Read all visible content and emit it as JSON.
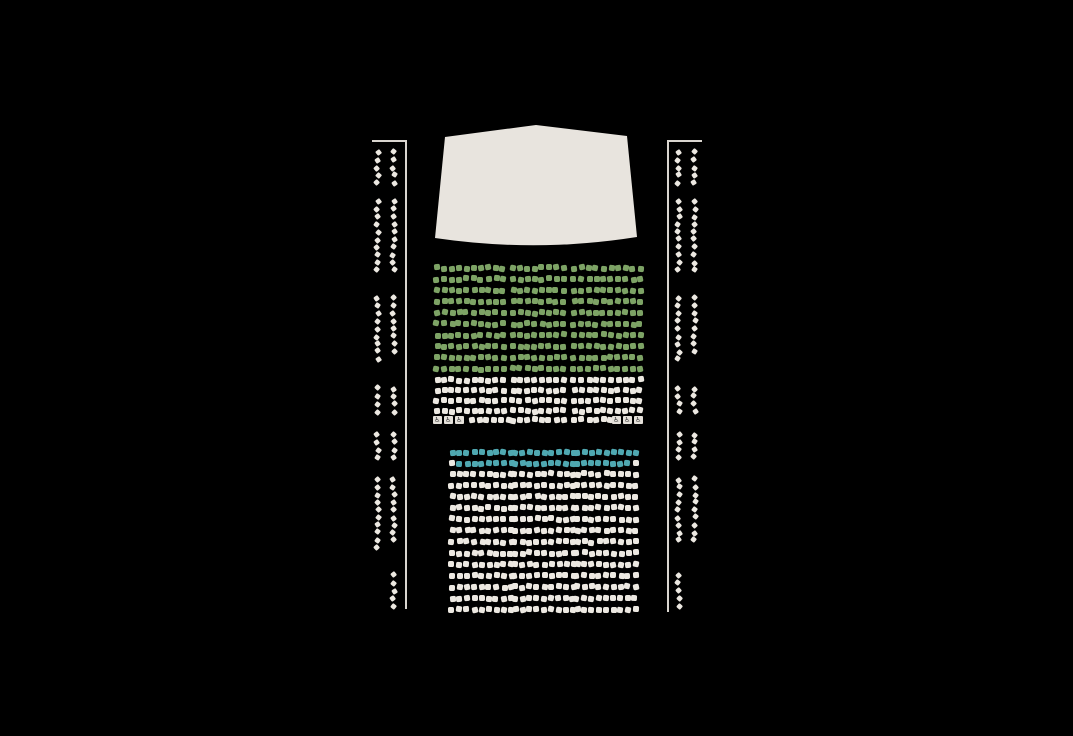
{
  "colors": {
    "background": "#000000",
    "stage_fill": "#e8e4de",
    "outline_line": "#d9d5cf",
    "green": "#7da365",
    "teal": "#4fa8b1",
    "cream": "#ece8e1",
    "wheelchair_fill": "#e5e1da",
    "wheelchair_glyph": "#3b3b3b"
  },
  "icons": {
    "wheelchair": "♿"
  },
  "seatmap": {
    "center_sections": [
      {
        "id": "front-orchestra",
        "blocks": [
          {
            "x": 434,
            "seat_count": 10,
            "seat_pitch": 7.35
          },
          {
            "x": 510,
            "seat_count": 8,
            "seat_pitch": 7.2
          },
          {
            "x": 571,
            "seat_count": 10,
            "seat_pitch": 7.35
          }
        ],
        "row_groups": [
          {
            "y": 265,
            "rows": 10,
            "row_pitch": 11.2,
            "color": "green"
          },
          {
            "y": 377,
            "rows": 4,
            "row_pitch": 10.3,
            "color": "cream"
          }
        ],
        "wheelchair_row": {
          "y": 417,
          "items": [
            {
              "type": "wheelchair",
              "x": 433
            },
            {
              "type": "wheelchair",
              "x": 444
            },
            {
              "type": "wheelchair",
              "x": 455
            },
            {
              "type": "seat",
              "x": 469
            },
            {
              "type": "seat",
              "x": 476
            },
            {
              "type": "seat",
              "x": 484
            },
            {
              "type": "seat",
              "x": 491
            },
            {
              "type": "seat",
              "x": 498
            },
            {
              "type": "seat",
              "x": 506
            },
            {
              "type": "seat",
              "x": 510
            },
            {
              "type": "seat",
              "x": 517
            },
            {
              "type": "seat",
              "x": 524
            },
            {
              "type": "seat",
              "x": 532
            },
            {
              "type": "seat",
              "x": 539
            },
            {
              "type": "seat",
              "x": 546
            },
            {
              "type": "seat",
              "x": 553
            },
            {
              "type": "seat",
              "x": 560
            },
            {
              "type": "seat",
              "x": 571
            },
            {
              "type": "seat",
              "x": 578
            },
            {
              "type": "seat",
              "x": 586
            },
            {
              "type": "seat",
              "x": 593
            },
            {
              "type": "seat",
              "x": 600
            },
            {
              "type": "seat",
              "x": 608
            },
            {
              "type": "wheelchair",
              "x": 612
            },
            {
              "type": "wheelchair",
              "x": 623
            },
            {
              "type": "wheelchair",
              "x": 634
            }
          ]
        }
      },
      {
        "id": "rear-orchestra",
        "blocks": [
          {
            "x": 449,
            "seat_count": 9,
            "seat_pitch": 7.4
          },
          {
            "x": 512,
            "seat_count": 9,
            "seat_pitch": 7.3
          },
          {
            "x": 574,
            "seat_count": 9,
            "seat_pitch": 7.3
          }
        ],
        "row_groups": [
          {
            "y": 449.5,
            "rows": 2,
            "row_pitch": 10.8,
            "color": "teal",
            "overrides": [
              {
                "row": 1,
                "block": 0,
                "seat": 0,
                "color": "cream"
              },
              {
                "row": 1,
                "block": 2,
                "seat": 8,
                "color": "cream"
              }
            ]
          },
          {
            "y": 471,
            "rows": 13,
            "row_pitch": 11.3,
            "color": "cream"
          }
        ]
      }
    ],
    "side_sections": [
      {
        "id": "left-boxes",
        "border": {
          "horizontal": {
            "x": 372,
            "y": 140,
            "length": 35
          },
          "vertical": {
            "x": 405,
            "y": 140,
            "length": 469
          }
        },
        "columns": [
          375,
          391
        ],
        "seat_pitch": 7.6,
        "clusters": [
          {
            "y": 150,
            "counts": [
              5,
              5
            ]
          },
          {
            "y": 199,
            "counts": [
              10,
              10
            ]
          },
          {
            "y": 296,
            "counts": [
              9,
              8
            ]
          },
          {
            "y": 386,
            "counts": [
              4,
              4
            ]
          },
          {
            "y": 432,
            "counts": [
              4,
              4
            ]
          },
          {
            "y": 477,
            "counts": [
              10,
              9
            ]
          },
          {
            "y": 573,
            "counts": [
              0,
              5
            ]
          }
        ]
      },
      {
        "id": "right-boxes",
        "border": {
          "horizontal": {
            "x": 667,
            "y": 140,
            "length": 35
          },
          "vertical": {
            "x": 667,
            "y": 140,
            "length": 472
          }
        },
        "columns": [
          676,
          692
        ],
        "seat_pitch": 7.6,
        "clusters": [
          {
            "y": 150,
            "counts": [
              5,
              5
            ]
          },
          {
            "y": 199,
            "counts": [
              10,
              10
            ]
          },
          {
            "y": 296,
            "counts": [
              9,
              8
            ]
          },
          {
            "y": 386,
            "counts": [
              4,
              4
            ]
          },
          {
            "y": 432,
            "counts": [
              4,
              4
            ]
          },
          {
            "y": 477,
            "counts": [
              9,
              9
            ]
          },
          {
            "y": 573,
            "counts": [
              5,
              0
            ]
          }
        ]
      }
    ]
  }
}
